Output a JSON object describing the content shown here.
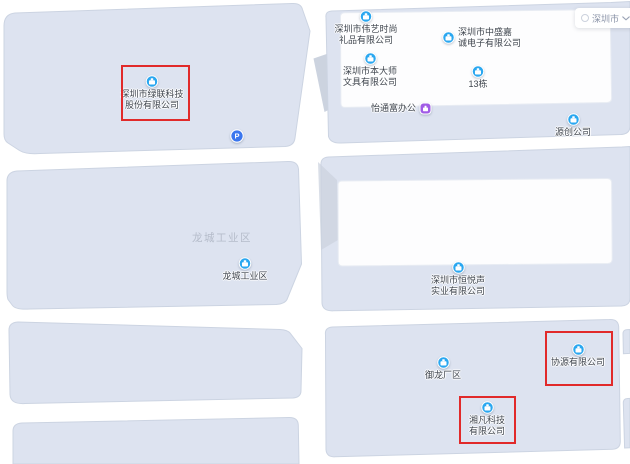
{
  "app": {
    "type": "map-view",
    "city_selector": {
      "city": "深圳市"
    }
  },
  "area_labels": [
    {
      "text": "龙城工业区"
    }
  ],
  "pois": [
    {
      "name": "深圳市绿联科技股份有限公司",
      "lines": [
        "深圳市绿联科技",
        "股份有限公司"
      ],
      "type": "company",
      "highlighted": true
    },
    {
      "name": "深圳市伟艺时尚礼品有限公司",
      "lines": [
        "深圳市伟艺时尚",
        "礼品有限公司"
      ],
      "type": "company",
      "highlighted": false
    },
    {
      "name": "深圳市中盛嘉诚电子有限公司",
      "lines": [
        "深圳市中盛嘉",
        "诚电子有限公司"
      ],
      "type": "company",
      "highlighted": false
    },
    {
      "name": "深圳市本大师文具有限公司",
      "lines": [
        "深圳市本大师",
        "文具有限公司"
      ],
      "type": "company",
      "highlighted": false
    },
    {
      "name": "13栋",
      "lines": [
        "13栋"
      ],
      "type": "building",
      "highlighted": false
    },
    {
      "name": "怡通富办公",
      "lines": [
        "怡通富办公"
      ],
      "type": "office",
      "highlighted": false
    },
    {
      "name": "源创公司",
      "lines": [
        "源创公司"
      ],
      "type": "company",
      "highlighted": false
    },
    {
      "name": "龙城工业区",
      "lines": [
        "龙城工业区"
      ],
      "type": "company",
      "highlighted": false
    },
    {
      "name": "深圳市恒悦声实业有限公司",
      "lines": [
        "深圳市恒悦声",
        "实业有限公司"
      ],
      "type": "company",
      "highlighted": false
    },
    {
      "name": "御龙厂区",
      "lines": [
        "御龙厂区"
      ],
      "type": "company",
      "highlighted": false
    },
    {
      "name": "协源有限公司",
      "lines": [
        "协源有限公司"
      ],
      "type": "company",
      "highlighted": true
    },
    {
      "name": "湘凡科技有限公司",
      "lines": [
        "湘凡科技",
        "有限公司"
      ],
      "type": "company",
      "highlighted": true
    }
  ],
  "parking": {
    "letter": "P"
  },
  "highlighted_pois": [
    "深圳市绿联科技股份有限公司",
    "协源有限公司",
    "湘凡科技有限公司"
  ],
  "theme": {
    "poi_blue": "#2aa7f0",
    "office_purple": "#a05ce6",
    "parking_blue": "#3a76ee",
    "highlight_red": "#e12a2a",
    "building_fill": "#dde3f0",
    "building_stroke": "#ccd4e2",
    "wall_fill": "#ccd3df",
    "roof_fill": "#fdfdfe",
    "label_text": "#3f454e",
    "area_label_gray": "#b5bcca",
    "selector_text": "#8b94a8"
  }
}
